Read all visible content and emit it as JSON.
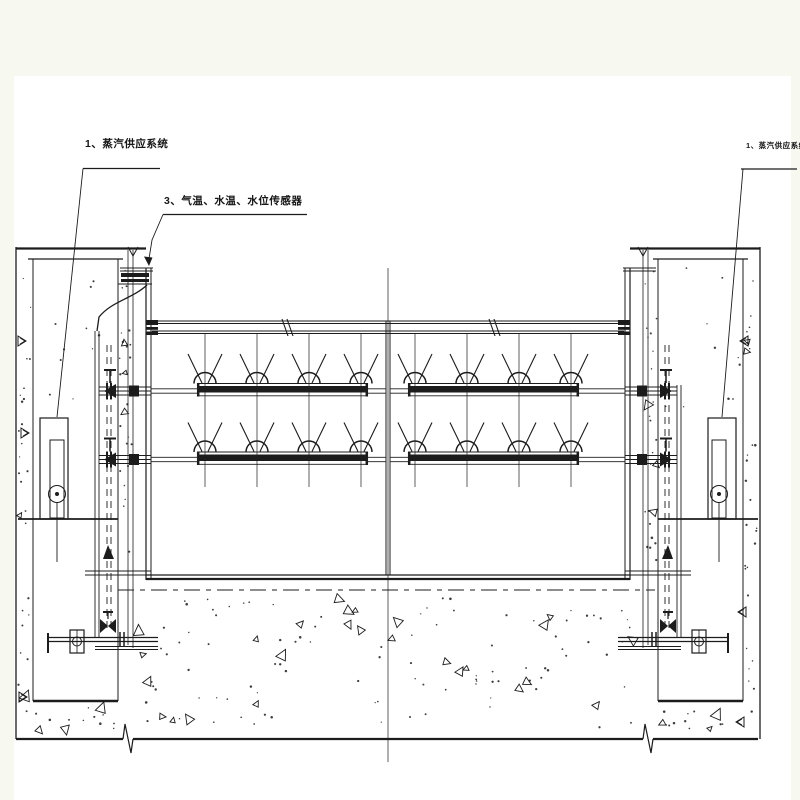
{
  "drawing": {
    "title_labels": {
      "steam_left": "1、蒸汽供应系统",
      "sensors": "3、气温、水温、水位传感器",
      "steam_right": "1、蒸汽供应系统"
    },
    "colors": {
      "ink": "#1c1c1c",
      "paper": "#ffffff",
      "margin": "#f7f9f0"
    }
  }
}
